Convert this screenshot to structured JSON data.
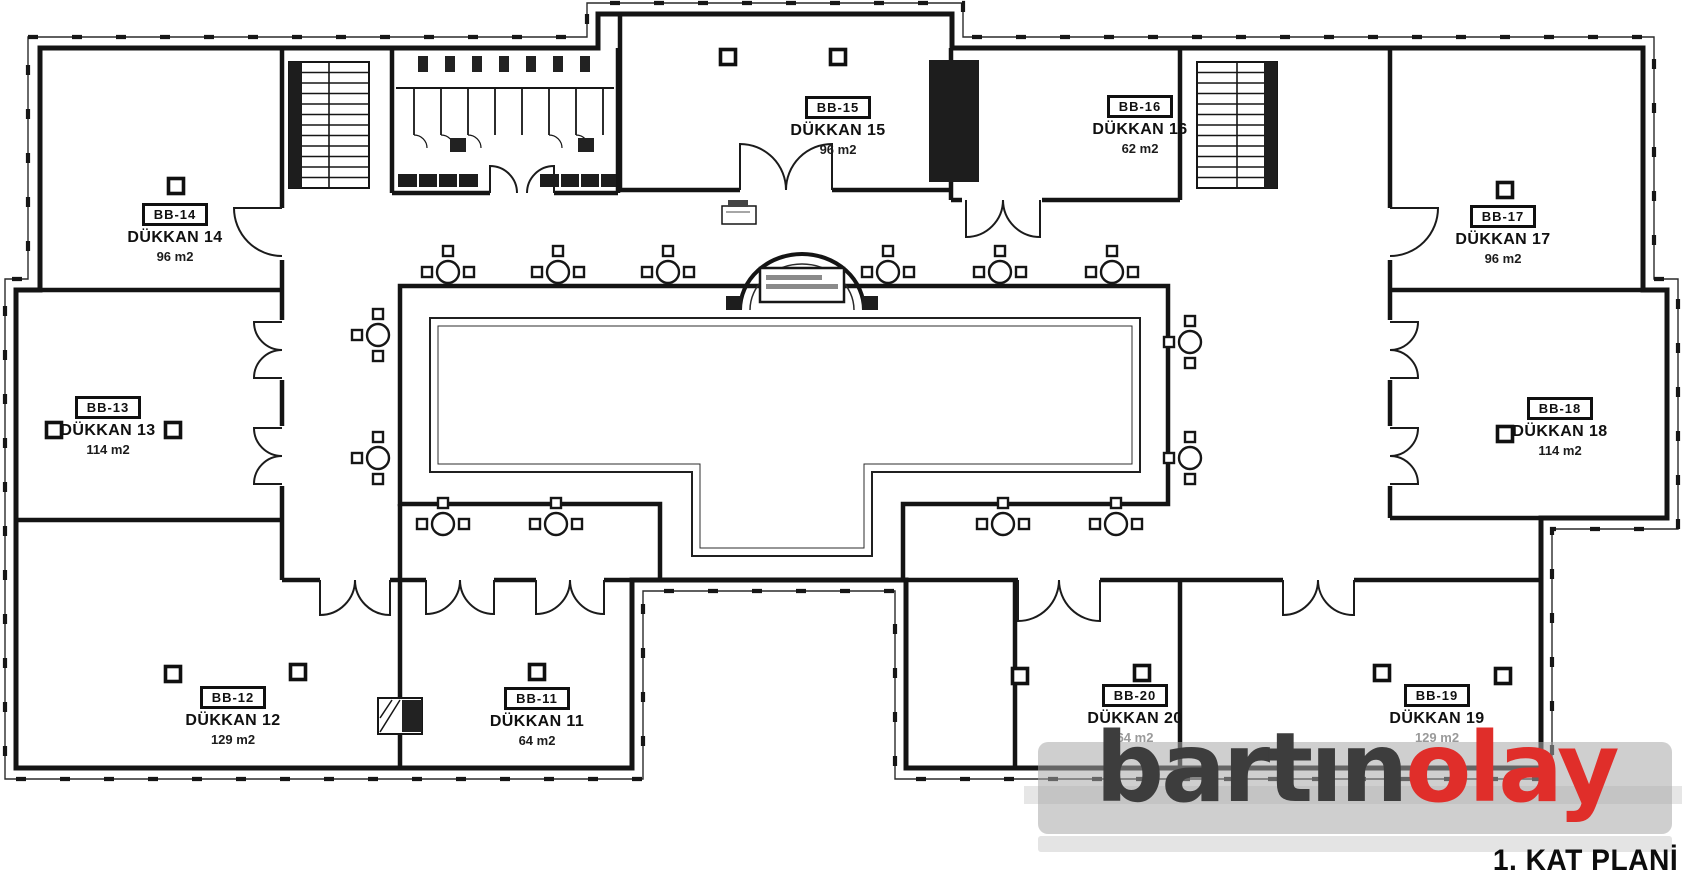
{
  "plan": {
    "title": "1. KAT PLANİ",
    "type_label": "floor-plan"
  },
  "watermark": {
    "text_dark": "bartın",
    "text_red": "olay",
    "dark_color": "#3d3d3d",
    "red_color": "#e02e2a"
  },
  "rooms": [
    {
      "id": "BB-14",
      "name": "DÜKKAN 14",
      "area": "96 m2"
    },
    {
      "id": "BB-15",
      "name": "DÜKKAN 15",
      "area": "96 m2"
    },
    {
      "id": "BB-16",
      "name": "DÜKKAN 16",
      "area": "62 m2"
    },
    {
      "id": "BB-17",
      "name": "DÜKKAN 17",
      "area": "96 m2"
    },
    {
      "id": "BB-13",
      "name": "DÜKKAN 13",
      "area": "114 m2"
    },
    {
      "id": "BB-18",
      "name": "DÜKKAN 18",
      "area": "114 m2"
    },
    {
      "id": "BB-12",
      "name": "DÜKKAN 12",
      "area": "129 m2"
    },
    {
      "id": "BB-11",
      "name": "DÜKKAN 11",
      "area": "64 m2"
    },
    {
      "id": "BB-20",
      "name": "DÜKKAN 20",
      "area": "64 m2"
    },
    {
      "id": "BB-19",
      "name": "DÜKKAN 19",
      "area": "129 m2"
    }
  ]
}
